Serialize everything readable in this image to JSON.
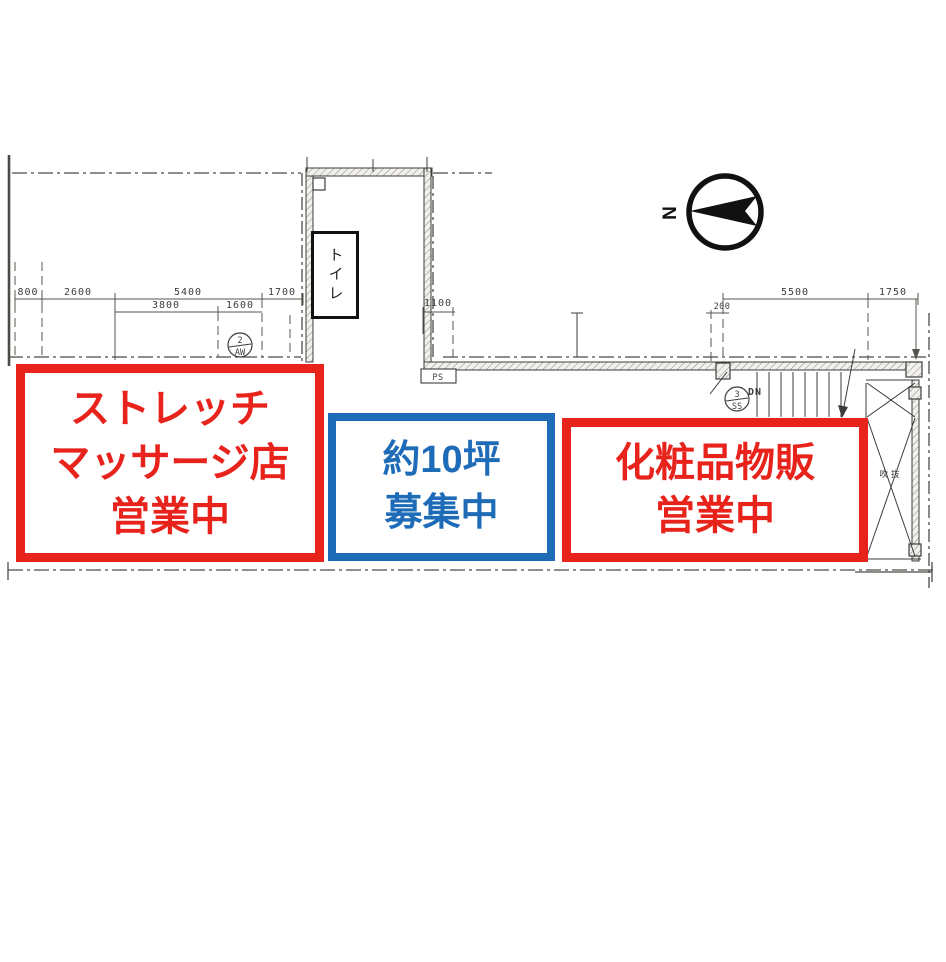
{
  "colors": {
    "red": "#e8231c",
    "blue": "#1e6cb8",
    "line": "#3c3c3c"
  },
  "compass": {
    "north_label": "N"
  },
  "floor_plan": {
    "toilet_label": "トイレ",
    "ps_label": "PS",
    "stairs_down_label": "DN",
    "void_label": "吹抜",
    "tags": [
      {
        "number": "2",
        "code": "AW"
      },
      {
        "number": "3",
        "code": "SS"
      }
    ],
    "dimensions": {
      "top_left_row1": [
        "800",
        "2600",
        "5400",
        "1700"
      ],
      "top_left_row2": [
        "3800",
        "1600"
      ],
      "corridor": [
        "1100"
      ],
      "top_right": [
        "200",
        "5500",
        "1750"
      ]
    }
  },
  "unit_labels": [
    {
      "id": "stretch-massage",
      "border_color": "#e8231c",
      "lines": [
        "ストレッチ",
        "マッサージ店",
        "営業中"
      ]
    },
    {
      "id": "vacancy",
      "border_color": "#1e6cb8",
      "lines": [
        "約10坪",
        "募集中"
      ]
    },
    {
      "id": "cosmetics",
      "border_color": "#e8231c",
      "lines": [
        "化粧品物販",
        "営業中"
      ]
    }
  ]
}
